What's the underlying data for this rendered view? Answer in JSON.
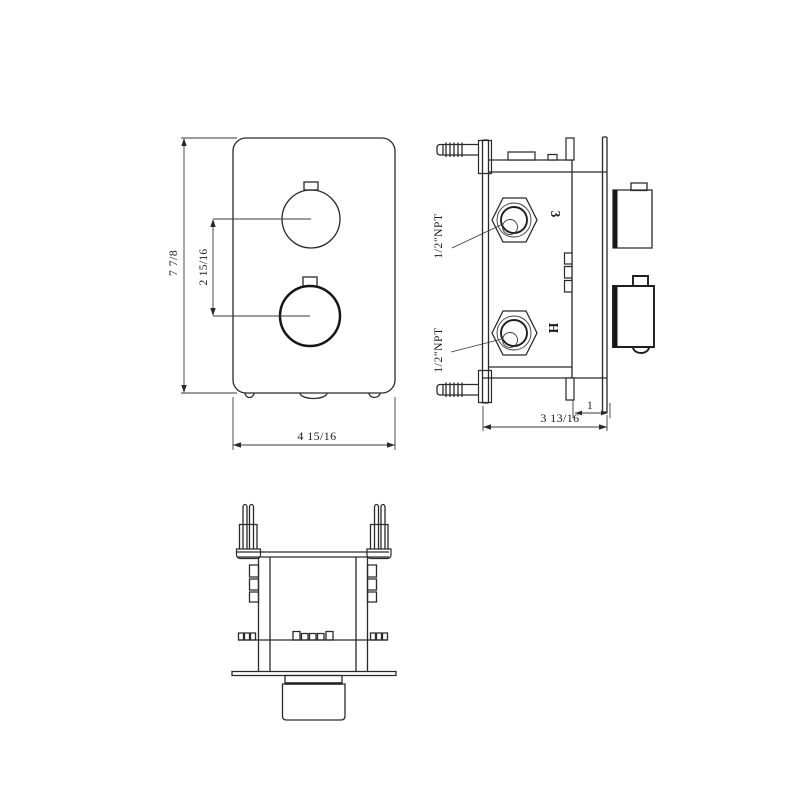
{
  "page": {
    "background": "#ffffff",
    "line_color": "#2a2a2a"
  },
  "drawing": {
    "front_view": {
      "dims": {
        "height": "7 7/8",
        "knob_spacing": "2 15/16",
        "width": "4 15/16"
      }
    },
    "side_view": {
      "ports": {
        "top_thread": "1/2\"NPT",
        "bottom_thread": "1/2\"NPT",
        "top_mark": "3",
        "bottom_mark": "H"
      },
      "dims": {
        "plate_gap": "1",
        "depth": "3 13/16"
      }
    },
    "bottom_view": {}
  }
}
